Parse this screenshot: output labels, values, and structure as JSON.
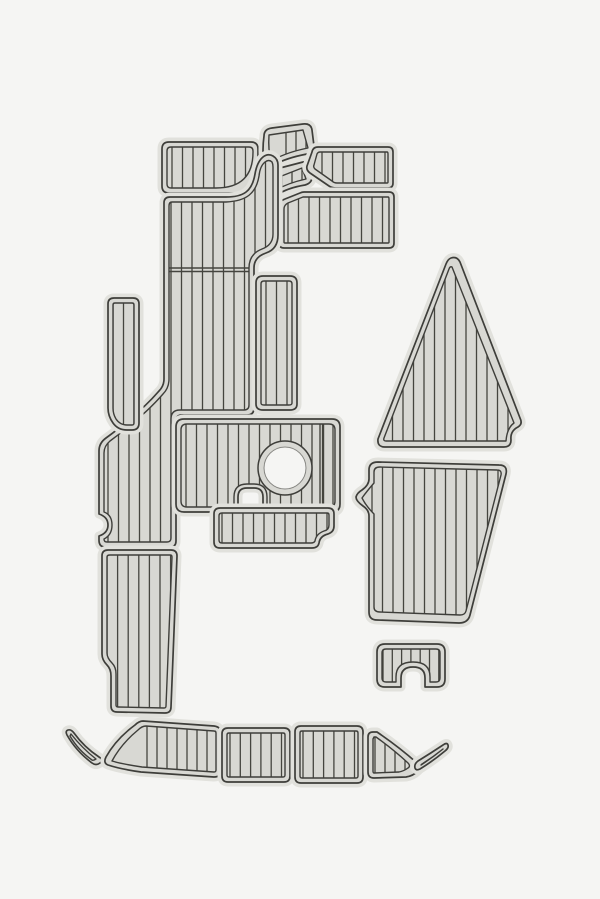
{
  "meta": {
    "description": "Product render: boat EVA foam teak decking pad kit, 19 gray plank-textured pieces arranged on a plain light background",
    "pieces_count": 19
  },
  "canvas": {
    "width": 600,
    "height": 899,
    "background": "#f5f5f3"
  },
  "palette": {
    "background": "#f5f5f3",
    "pad_field": "#d8d8d3",
    "pad_rim": "#e1e1dc",
    "outline_dark": "#3e3e3a",
    "plank_line": "#45453f",
    "hole_edge": "#c9c9c5"
  },
  "pads": [
    {
      "name": "pad-top-left-panel",
      "outer": "M169,142 L251,142 Q258,142 258,149 L258,186 Q258,193 251,193 L169,193 Q162,193 162,186 L162,149 Q162,142 169,142 Z",
      "inner": "M171,147 L249,147 Q253,147 253,151 L253,152 Q253,188 216,188 L171,188 Q167,188 167,184 L167,151 Q167,147 171,147 Z",
      "planks": {
        "x0": 172,
        "x1": 252,
        "step": 10.5,
        "y0": 140,
        "y1": 195
      }
    },
    {
      "name": "pad-wedge-upper",
      "outer": "M269,168 Q265,170 264,165 Q262,150 264,136 Q264,129 272,128 L303,124 Q311,123 312,130 L314,146 Q314,152 307,154 Q286,158 274,165 Q271,167 269,168 Z",
      "inner": "M271,161 Q268,150 269,135 L303,130 L308,148 Q288,152 275,159 Q272,161 271,161 Z",
      "planks": {
        "x0": 286,
        "x1": 306,
        "step": 10,
        "y0": 122,
        "y1": 170
      }
    },
    {
      "name": "pad-wedge-lower",
      "outer": "M268,199 Q263,201 263,196 Q263,186 268,177 Q272,170 280,168 L303,162 Q310,160 311,167 L312,177 Q312,183 305,185 Q287,188 277,195 Q272,199 268,199 Z",
      "inner": "M270,192 Q270,185 274,179 L302,168 L306,179 Q288,183 276,190 Q272,193 270,192 Z",
      "planks": {
        "x0": 282,
        "x1": 302,
        "step": 10,
        "y0": 158,
        "y1": 200
      }
    },
    {
      "name": "pad-parallelogram-top-right",
      "outer": "M318,147 L388,147 Q393,147 393,152 L393,183 Q393,188 388,188 L336,188 Q332,188 329,186 L310,173 Q306,170 307,166 L312,152 Q313,147 318,147 Z",
      "inner": "M320,152 L387,152 Q388,152 388,154 L388,182 Q388,183 387,183 L337,183 Q334,183 332,181 L315,169 Q313,167 314,165 L317,154 Q318,152 320,152 Z",
      "planks": {
        "x0": 322,
        "x1": 390,
        "step": 10.5,
        "y0": 145,
        "y1": 190
      }
    },
    {
      "name": "pad-rect-upper-right",
      "outer": "M304,192 L389,192 Q394,192 394,197 L394,243 Q394,248 389,248 L284,248 Q279,248 279,243 L279,208 Q279,201 285,199 L300,193 Q302,192 304,192 Z",
      "inner": "M306,197 L388,197 Q389,197 389,199 L389,242 Q389,243 388,243 L285,243 Q284,243 284,242 L284,209 Q284,205 288,203 L303,197 Z",
      "planks": {
        "x0": 288,
        "x1": 392,
        "step": 10.5,
        "y0": 190,
        "y1": 250
      }
    },
    {
      "name": "pad-main-walkway",
      "outer": "M170,197 L226,197 C243,197 252,192 255,174 Q257,162 263,157 Q268,153 273,156 Q278,159 278,165 L278,235 Q278,249 266,253 Q254,257 254,268 L254,408 Q254,415 247,415 L182,415 Q176,415 176,421 L176,541 Q176,547 170,547 L105,547 Q99,547 99,540 L99,536 Q108,533 108,525 Q108,517 99,514 L99,451 Q99,443 106,438 Q140,413 159,391 Q164,386 164,379 L164,203 Q164,197 170,197 Z",
      "inner": "M172,202 L226,202 C246,201 256,194 259,176 Q260,166 265,162 Q269,159 272,162 Q273,164 273,167 L273,234 Q273,245 262,249 Q249,254 249,268 L249,405 Q249,410 244,410 L180,410 Q171,410 171,419 L171,538 Q171,542 167,542 L107,542 Q104,542 104,539 Q112,535 112,525 Q112,515 104,512 L104,453 Q104,446 110,441 Q144,416 163,394 Q169,388 169,379 L169,206 Q169,202 172,202 Z",
      "planks": {
        "x0": 108,
        "x1": 274,
        "step": 10.5,
        "y0": 150,
        "y1": 550
      },
      "seams": [
        [
          165,
          268,
          251,
          268
        ],
        [
          165,
          271.5,
          251,
          271.5
        ]
      ]
    },
    {
      "name": "pad-walkthrough-column",
      "outer": "M263,276 L290,276 Q297,276 297,283 L297,404 Q297,410 290,410 L263,410 Q256,410 256,404 L256,283 Q256,276 263,276 Z",
      "inner": "M264,281 L289,281 Q292,281 292,284 L292,403 Q292,405 289,405 L264,405 Q261,405 261,403 L261,284 Q261,281 264,281 Z",
      "planks": {
        "x0": 266,
        "x1": 292,
        "step": 10.5,
        "y0": 274,
        "y1": 412
      }
    },
    {
      "name": "pad-hatch-with-circle",
      "outer": "M184,419 L332,419 Q340,419 340,427 L340,504 Q340,512 332,512 L263,512 L263,497 Q263,488 254,488 L247,488 Q238,488 238,497 L238,512 L184,512 Q176,512 176,504 L176,427 Q176,419 184,419 Z",
      "inner": "M187,424 L329,424 Q335,424 335,430 L335,501 Q335,507 329,507 L267,507 L267,497 Q267,484 254,484 L247,484 Q234,484 234,497 L234,507 L187,507 Q181,507 181,501 L181,430 Q181,424 187,424 Z",
      "planks": {
        "x0": 186,
        "x1": 334,
        "step": 10.5,
        "y0": 417,
        "y1": 515
      },
      "seams": [
        [
          320,
          424,
          320,
          507
        ],
        [
          323.5,
          424,
          323.5,
          507
        ]
      ],
      "cutouts": [
        {
          "type": "circle",
          "cx": 285,
          "cy": 468,
          "r_field": 27,
          "r_hole": 21
        }
      ]
    },
    {
      "name": "pad-aft-strip",
      "outer": "M220,508 L328,508 Q334,508 334,514 L334,526 Q334,532 328,534 Q320,536 319,543 Q318,548 312,548 L220,548 Q214,548 214,542 L214,514 Q214,508 220,508 Z",
      "inner": "M222,513 L327,513 Q329,513 329,515 L329,525 Q329,530 324,531 Q316,534 315,541 Q314,543 311,543 L222,543 Q219,543 219,540 L219,516 Q219,513 222,513 Z",
      "planks": {
        "x0": 222,
        "x1": 332,
        "step": 10.5,
        "y0": 506,
        "y1": 550
      }
    },
    {
      "name": "pad-side-strip-left",
      "outer": "M114,298 L133,298 Q139,298 139,304 L139,423 Q139,430 132,430 L127,430 Q118,430 113,423 Q108,416 108,408 L108,304 Q108,298 114,298 Z",
      "inner": "M115,303 L132,303 Q134,303 134,305 L134,423 Q134,425 132,425 L127,425 Q120,425 116,419 Q113,414 113,408 L113,305 Q113,303 115,303 Z",
      "planks": {
        "x0": 113,
        "x1": 135,
        "step": 10.5,
        "y0": 296,
        "y1": 432
      }
    },
    {
      "name": "pad-bow-triangle",
      "outer": "M451,258 Q457,256 460,262 L520,418 Q523,424 518,427 Q510,431 511,440 Q511,447 504,447 L385,447 Q377,447 378,439 L446,264 Q448,259 451,258 Z",
      "inner": "M452,267 L514,423 Q507,428 506,441 L386,441 Q383,441 384,438 L449,269 Q450,266 452,267 Z",
      "planks": {
        "x0": 382,
        "x1": 518,
        "step": 10.5,
        "y0": 255,
        "y1": 450
      }
    },
    {
      "name": "pad-aft-trapezoid",
      "outer": "M378,462 L499,465 Q508,465 506,474 L470,615 Q468,623 459,623 L377,620 Q369,620 369,612 L369,516 Q369,510 363,506 Q356,501 356,497 Q357,493 362,490 Q369,485 369,479 L369,470 Q369,462 378,462 Z",
      "inner": "M380,467 L497,470 Q502,470 501,475 L466,611 Q465,615 460,615 L380,612 Q374,612 374,607 L374,514 Q366,506 362,498 Q367,491 374,483 L374,472 Q374,467 380,467 Z",
      "planks": {
        "x0": 372,
        "x1": 506,
        "step": 10.5,
        "y0": 460,
        "y1": 628
      }
    },
    {
      "name": "pad-transom-step-notched",
      "outer": "M385,644 L437,644 Q445,644 445,652 L445,679 Q445,687 437,687 L425,687 L425,678 Q425,667 413,667 Q401,667 401,678 L401,687 L385,687 Q377,687 377,679 L377,652 Q377,644 385,644 Z",
      "inner": "M386,649 L436,649 Q440,649 440,653 L440,678 Q440,682 436,682 L430,682 L430,677 Q430,662 413,662 Q396,662 396,677 L396,682 L386,682 Q382,682 382,678 L382,653 Q382,649 386,649 Z",
      "planks": {
        "x0": 383,
        "x1": 440,
        "step": 9.3,
        "y0": 642,
        "y1": 690
      }
    },
    {
      "name": "pad-lower-left-column",
      "outer": "M108,550 L171,550 Q177,550 177,556 L171,707 Q171,713 165,713 L117,712 Q111,712 111,706 L111,676 Q111,669 107,665 Q102,660 102,654 L102,556 Q102,550 108,550 Z",
      "inner": "M110,555 L170,555 Q172,555 172,557 L166,706 Q166,708 164,708 L118,707 Q116,707 116,705 L116,674 Q116,667 112,663 Q107,658 107,653 L107,557 Q107,555 110,555 Z",
      "planks": {
        "x0": 107,
        "x1": 172,
        "step": 10.6,
        "y0": 548,
        "y1": 716
      }
    },
    {
      "name": "pad-gunnel-sliver-left",
      "outer": "M68,730 Q71,729 74,733 Q84,747 99,757 Q104,760 100,763 Q96,766 92,763 Q76,751 67,735 Q65,731 68,730 Z",
      "inner": "M71,734 Q82,748 96,759 Q93,761 92,760 Q78,750 70,736 Z",
      "planks": null
    },
    {
      "name": "pad-gunnel-left",
      "outer": "M143,721 L214,726 Q221,727 221,733 L221,770 Q221,777 214,777 L141,772 Q120,769 108,765 Q103,763 106,757 Q116,739 135,725 Q139,721 143,721 Z",
      "inner": "M146,726 L214,731 Q216,731 216,733 L216,770 Q216,772 214,772 L142,767 Q122,764 112,761 Q121,744 138,730 Q142,726 146,726 Z",
      "planks": {
        "x0": 147,
        "x1": 218,
        "step": 10,
        "y0": 718,
        "y1": 780
      }
    },
    {
      "name": "pad-gunnel-center-left",
      "outer": "M228,728 L284,728 Q290,728 290,734 L290,776 Q290,782 284,782 L228,782 Q222,782 222,776 L222,734 Q222,728 228,728 Z",
      "inner": "M229,733 L283,733 Q285,733 285,735 L285,775 Q285,777 283,777 L229,777 Q227,777 227,775 L227,735 Q227,733 229,733 Z",
      "planks": {
        "x0": 230,
        "x1": 288,
        "step": 10.3,
        "y0": 726,
        "y1": 784
      }
    },
    {
      "name": "pad-gunnel-center-right",
      "outer": "M301,726 L357,726 Q363,726 363,732 L363,777 Q363,783 357,783 L301,783 Q295,783 295,777 L295,732 Q295,726 301,726 Z",
      "inner": "M302,731 L356,731 Q358,731 358,733 L358,776 Q358,778 356,778 L302,778 Q300,778 300,776 L300,733 Q300,731 302,731 Z",
      "planks": {
        "x0": 303,
        "x1": 361,
        "step": 10.3,
        "y0": 724,
        "y1": 785
      }
    },
    {
      "name": "pad-gunnel-right",
      "outer": "M373,732 L377,732 Q399,747 417,763 Q422,767 418,771 Q413,776 406,777 L374,778 Q368,778 368,772 L368,737 Q368,732 373,732 Z",
      "inner": "M374,737 L376,737 Q394,750 408,763 Q411,766 408,768 Q404,771 399,772 L374,773 Q373,773 373,771 L373,739 Z",
      "planks": {
        "x0": 375,
        "x1": 405,
        "step": 10,
        "y0": 730,
        "y1": 780
      }
    },
    {
      "name": "pad-gunnel-sliver-right",
      "outer": "M420,769 Q416,771 415,768 Q414,764 418,761 Q431,753 443,745 Q447,742 448,745 Q449,748 445,751 Q433,761 420,769 Z",
      "inner": "M421,765 Q432,758 443,749 Q433,757 422,764 Z",
      "planks": null
    }
  ]
}
